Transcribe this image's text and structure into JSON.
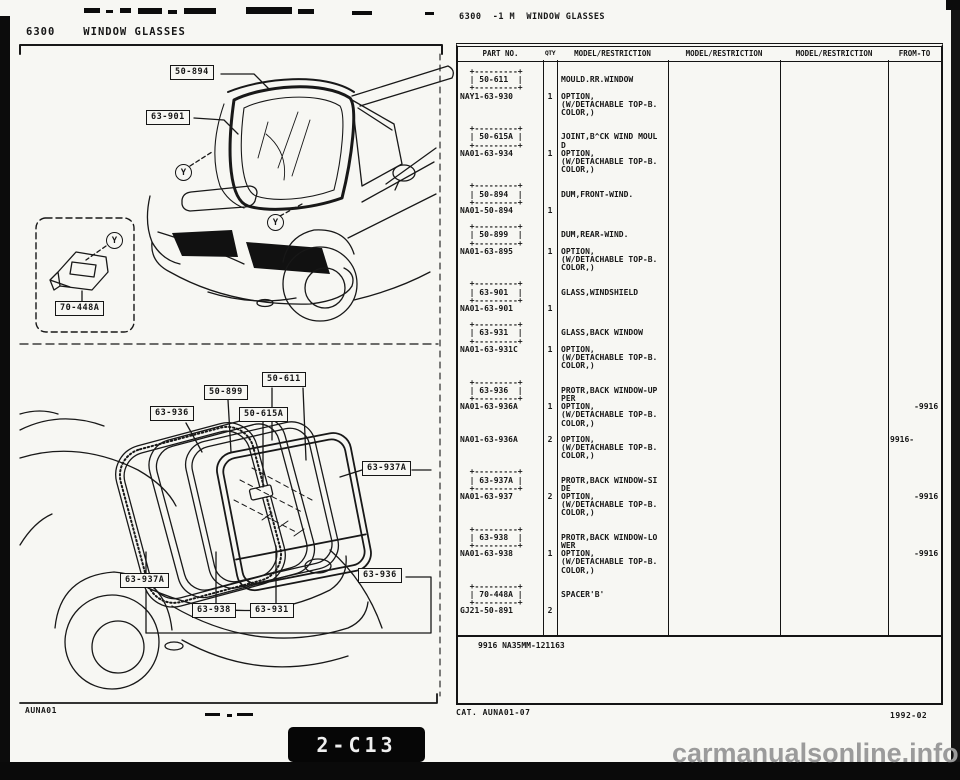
{
  "left_page": {
    "header_code": "6300",
    "header_title": "WINDOW GLASSES",
    "glass_symbol": "Y",
    "footer_code": "AUNA01",
    "labels": [
      {
        "id": "windshield-moulding",
        "text": "50-894"
      },
      {
        "id": "windshield-glass",
        "text": "63-901"
      },
      {
        "id": "spacer-b",
        "text": "70-448A"
      },
      {
        "id": "rear-dam",
        "text": "50-899"
      },
      {
        "id": "rear-moulding",
        "text": "50-611"
      },
      {
        "id": "protector-upper",
        "text": "63-936"
      },
      {
        "id": "joint-moulding",
        "text": "50-615A"
      },
      {
        "id": "protector-side-right",
        "text": "63-937A"
      },
      {
        "id": "protector-side-left",
        "text": "63-937A"
      },
      {
        "id": "protector-lower",
        "text": "63-938"
      },
      {
        "id": "back-window-glass",
        "text": "63-931"
      },
      {
        "id": "protector-upper-right",
        "text": "63-936"
      }
    ]
  },
  "right_page": {
    "header": "6300  -1 M  WINDOW GLASSES",
    "table": {
      "headers": [
        "PART NO.",
        "QTY",
        "MODEL/RESTRICTION",
        "MODEL/RESTRICTION",
        "MODEL/RESTRICTION",
        "FROM-TO"
      ],
      "rows": [
        {
          "part": "  +---------+\n  | 50-611  |\n  +---------+\nNAY1-63-930",
          "qty": "\n\n\n1",
          "desc": "\nMOULD.RR.WINDOW\n\nOPTION,\n(W/DETACHABLE TOP-B.\nCOLOR,)",
          "fromto": ""
        },
        {
          "part": "  +---------+\n  | 50-615A |\n  +---------+\nNA01-63-934",
          "qty": "\n\n\n1",
          "desc": "\nJOINT,B^CK WIND MOUL\nD\nOPTION,\n(W/DETACHABLE TOP-B.\nCOLOR,)",
          "fromto": ""
        },
        {
          "part": "  +---------+\n  | 50-894  |\n  +---------+\nNA01-50-894",
          "qty": "\n\n\n1",
          "desc": "\nDUM,FRONT-WIND.",
          "fromto": ""
        },
        {
          "part": "  +---------+\n  | 50-899  |\n  +---------+\nNA01-63-895",
          "qty": "\n\n\n1",
          "desc": "\nDUM,REAR-WIND.\n\nOPTION,\n(W/DETACHABLE TOP-B.\nCOLOR,)",
          "fromto": ""
        },
        {
          "part": "  +---------+\n  | 63-901  |\n  +---------+\nNA01-63-901",
          "qty": "\n\n\n1",
          "desc": "\nGLASS,WINDSHIELD",
          "fromto": ""
        },
        {
          "part": "  +---------+\n  | 63-931  |\n  +---------+\nNA01-63-931C",
          "qty": "\n\n\n1",
          "desc": "\nGLASS,BACK WINDOW\n\nOPTION,\n(W/DETACHABLE TOP-B.\nCOLOR,)",
          "fromto": ""
        },
        {
          "part": "  +---------+\n  | 63-936  |\n  +---------+\nNA01-63-936A",
          "qty": "\n\n\n1",
          "desc": "\nPROTR,BACK WINDOW-UP\nPER\nOPTION,\n(W/DETACHABLE TOP-B.\nCOLOR,)",
          "fromto": "\n\n\n     -9916"
        },
        {
          "part": "NA01-63-936A",
          "qty": "2",
          "desc": "OPTION,\n(W/DETACHABLE TOP-B.\nCOLOR,)",
          "fromto": "9916-"
        },
        {
          "part": "  +---------+\n  | 63-937A |\n  +---------+\nNA01-63-937",
          "qty": "\n\n\n2",
          "desc": "\nPROTR,BACK WINDOW-SI\nDE\nOPTION,\n(W/DETACHABLE TOP-B.\nCOLOR,)",
          "fromto": "\n\n\n     -9916"
        },
        {
          "part": "  +---------+\n  | 63-938  |\n  +---------+\nNA01-63-938",
          "qty": "\n\n\n1",
          "desc": "\nPROTR,BACK WINDOW-LO\nWER\nOPTION,\n(W/DETACHABLE TOP-B.\nCOLOR,)",
          "fromto": "\n\n\n     -9916"
        },
        {
          "part": "  +---------+\n  | 70-448A |\n  +---------+\nGJ21-50-891",
          "qty": "\n\n\n2",
          "desc": "\nSPACER'B'",
          "fromto": ""
        }
      ],
      "note": "9916 NA35MM-121163"
    },
    "footer_catalog": "CAT. AUNA01-07",
    "footer_date": "1992-02"
  },
  "overlay": {
    "page_ref": "2-C13",
    "watermark": "carmanualsonline.info"
  }
}
